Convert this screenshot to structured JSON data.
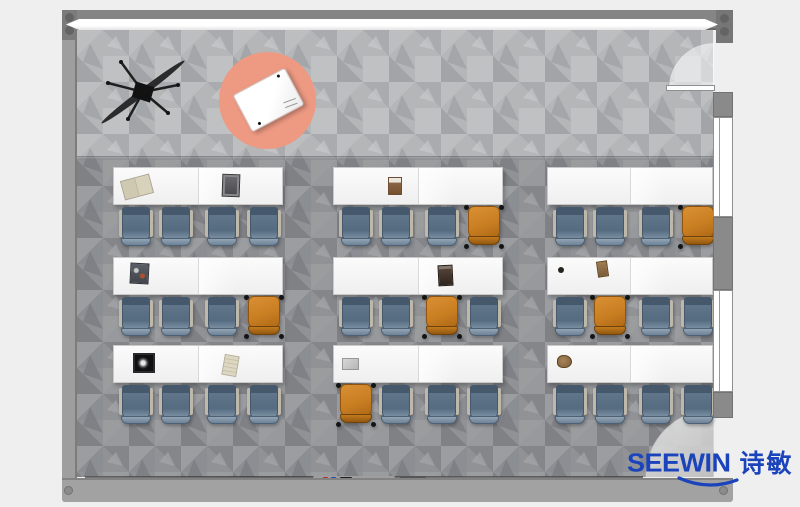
{
  "brand": {
    "name": "SEEWIN",
    "logo_text": "SEEWIN",
    "logo_cjk": "诗敏",
    "logo_color": "#1b43bb"
  },
  "colors": {
    "bg": "#efefef",
    "wall": "#8f8f8f",
    "wall_dark": "#6f6f6f",
    "wall_light": "#a3a3a3",
    "floor_main": "#909295",
    "floor_stage": "#b4b6b8",
    "rug": "#ee9a83",
    "table_white": "#fbfbfb",
    "chair_blue": "#64798d",
    "chair_blue_dark": "#46586c",
    "chair_blue_light": "#93a5b4",
    "chair_orange": "#c97e22",
    "chair_orange_dark": "#8f5510",
    "logo_blue": "#1b43bb"
  },
  "fixtures": {
    "ceiling_fan": "ceiling-fan-icon",
    "activity_rug": "round-rug",
    "podium_table": "teacher-table",
    "whiteboard": "whiteboard-strip",
    "doors": [
      "door-top-right",
      "door-bottom-right"
    ],
    "windows": [
      "window-upper",
      "window-lower"
    ]
  },
  "room": {
    "chair_offsets": [
      6,
      46,
      92,
      134
    ],
    "chair_top": 40,
    "desks": [
      {
        "id": "desk-front-left",
        "x": 113,
        "y": 167,
        "w": 170,
        "chairs": [
          "blue",
          "blue",
          "blue",
          "blue"
        ],
        "items": [
          {
            "type": "open-book",
            "x": 8,
            "y": 9,
            "r": -15
          },
          {
            "type": "tablet",
            "x": 108,
            "y": 6,
            "r": 2
          }
        ]
      },
      {
        "id": "desk-front-center",
        "x": 333,
        "y": 167,
        "w": 170,
        "chairs": [
          "blue",
          "blue",
          "blue",
          "orange"
        ],
        "items": [
          {
            "type": "brown-book",
            "x": 54,
            "y": 9,
            "r": 0
          }
        ]
      },
      {
        "id": "desk-front-right",
        "x": 547,
        "y": 167,
        "w": 166,
        "chairs": [
          "blue",
          "blue",
          "blue",
          "orange"
        ],
        "items": []
      },
      {
        "id": "desk-middle-left",
        "x": 113,
        "y": 257,
        "w": 170,
        "chairs": [
          "blue",
          "blue",
          "blue",
          "orange"
        ],
        "items": [
          {
            "type": "magazine",
            "x": 16,
            "y": 5,
            "r": 3
          }
        ]
      },
      {
        "id": "desk-middle-center",
        "x": 333,
        "y": 257,
        "w": 170,
        "chairs": [
          "blue",
          "blue",
          "orange",
          "blue"
        ],
        "items": [
          {
            "type": "dark-book",
            "x": 104,
            "y": 7,
            "r": -3
          }
        ]
      },
      {
        "id": "desk-middle-right",
        "x": 547,
        "y": 257,
        "w": 166,
        "chairs": [
          "blue",
          "orange",
          "blue",
          "blue"
        ],
        "items": [
          {
            "type": "dot",
            "x": 10,
            "y": 9,
            "r": 0
          },
          {
            "type": "small-brown",
            "x": 49,
            "y": 3,
            "r": -8
          }
        ]
      },
      {
        "id": "desk-back-left",
        "x": 113,
        "y": 345,
        "w": 170,
        "chairs": [
          "blue",
          "blue",
          "blue",
          "blue"
        ],
        "items": [
          {
            "type": "framed-pic",
            "x": 19,
            "y": 7,
            "r": 0
          },
          {
            "type": "paper",
            "x": 109,
            "y": 9,
            "r": 10
          }
        ]
      },
      {
        "id": "desk-back-center",
        "x": 333,
        "y": 345,
        "w": 170,
        "chairs": [
          "orange",
          "blue",
          "blue",
          "blue"
        ],
        "items": [
          {
            "type": "laptop",
            "x": 8,
            "y": 12,
            "r": 0
          }
        ]
      },
      {
        "id": "desk-back-right",
        "x": 547,
        "y": 345,
        "w": 166,
        "chairs": [
          "blue",
          "blue",
          "blue",
          "blue"
        ],
        "items": [
          {
            "type": "crumpled",
            "x": 9,
            "y": 9,
            "r": 0
          }
        ]
      }
    ]
  }
}
